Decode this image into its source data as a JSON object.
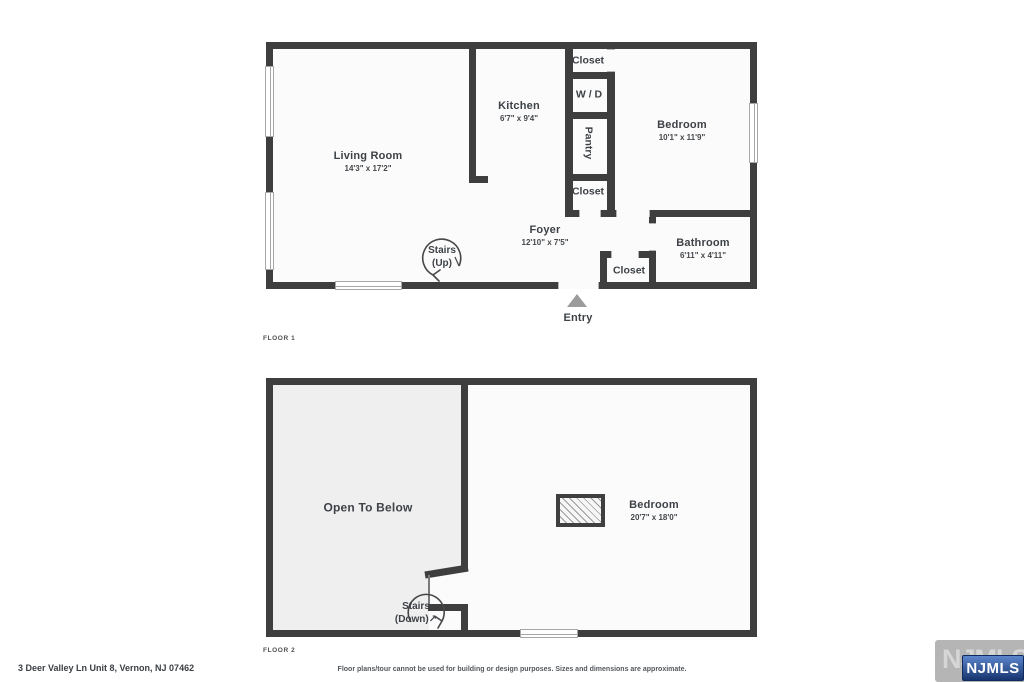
{
  "title_block": {
    "address": "3 Deer Valley Ln Unit 8, Vernon, NJ 07462",
    "disclaimer": "Floor plans/tour cannot be used for building or design purposes. Sizes and dimensions are approximate."
  },
  "branding": {
    "watermark_text": "NJMLS",
    "logo_text": "NJMLS"
  },
  "colors": {
    "wall": "#3e3e3e",
    "floor": "#fbfbfb",
    "open_to_below_fill": "#efefef",
    "entry_arrow": "#9c9c9c",
    "logo_blue_top": "#5c85cc",
    "logo_blue_bottom": "#16356f",
    "watermark_gray": "#b5b5b5"
  },
  "floor1": {
    "label": "FLOOR 1",
    "living_room": {
      "name": "Living Room",
      "dims": "14'3\" x 17'2\""
    },
    "kitchen": {
      "name": "Kitchen",
      "dims": "6'7\" x 9'4\""
    },
    "closet_top": {
      "name": "Closet"
    },
    "wd": {
      "name": "W / D"
    },
    "pantry": {
      "name": "Pantry"
    },
    "closet_mid": {
      "name": "Closet"
    },
    "bedroom": {
      "name": "Bedroom",
      "dims": "10'1\" x 11'9\""
    },
    "foyer": {
      "name": "Foyer",
      "dims": "12'10\" x 7'5\""
    },
    "bathroom": {
      "name": "Bathroom",
      "dims": "6'11\" x 4'11\""
    },
    "closet_foyer": {
      "name": "Closet"
    },
    "stairs": {
      "line1": "Stairs",
      "line2": "(Up)"
    },
    "entry_label": "Entry"
  },
  "floor2": {
    "label": "FLOOR 2",
    "open_to_below": "Open To Below",
    "bedroom": {
      "name": "Bedroom",
      "dims": "20'7\" x 18'0\""
    },
    "stairs": {
      "line1": "Stairs",
      "line2": "(Down)",
      "arrow": "↗"
    }
  }
}
